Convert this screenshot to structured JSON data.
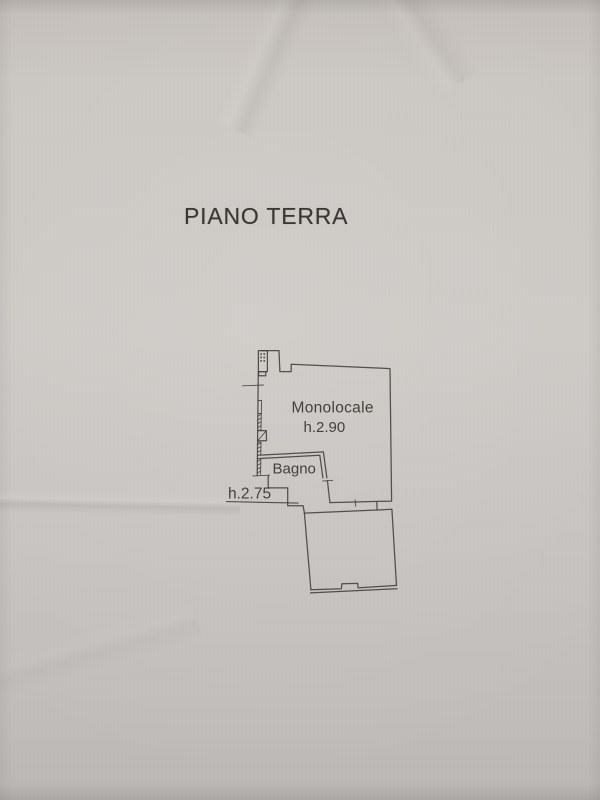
{
  "colors": {
    "paper": "#c8c4c0",
    "ink": "#474440",
    "text": "#3b3834"
  },
  "title": "PIANO TERRA",
  "floor_plan": {
    "rooms": [
      {
        "id": "monolocale",
        "label": "Monolocale",
        "ceiling_height": "h.2.90"
      },
      {
        "id": "bagno",
        "label": "Bagno"
      },
      {
        "id": "lower-room",
        "label": ""
      }
    ],
    "annotations": [
      {
        "id": "h275",
        "label": "h.2.75"
      }
    ]
  }
}
